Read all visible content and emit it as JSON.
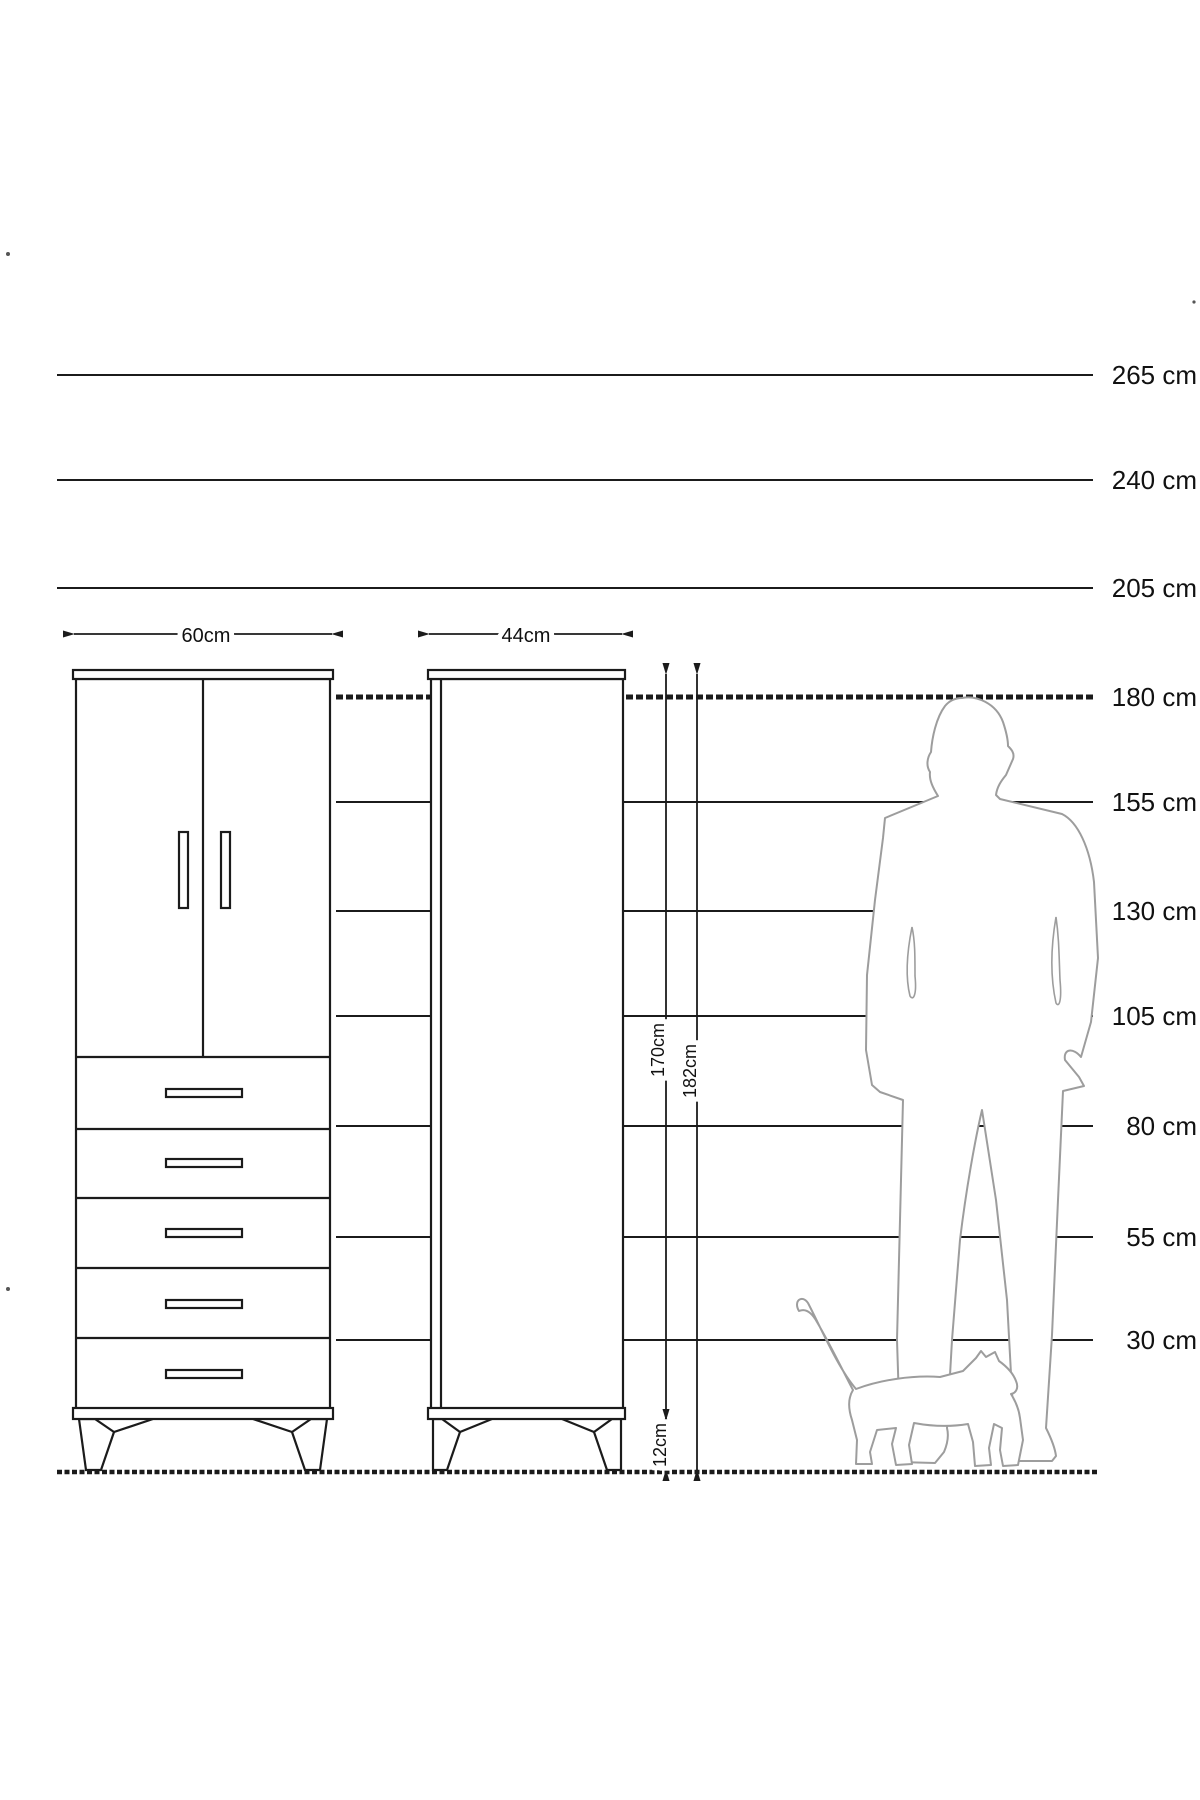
{
  "diagram": {
    "kind": "furniture size comparison diagram",
    "unit": "cm"
  },
  "colors": {
    "line_color": "#1b1b1b",
    "figure_outline": "#9d9d9d",
    "background": "#ffffff"
  },
  "scale": {
    "line_end_x": 1093,
    "label_x": 1197,
    "lines": [
      {
        "label": "265 cm",
        "y": 375,
        "x1": 57,
        "style": "solid"
      },
      {
        "label": "240 cm",
        "y": 480,
        "x1": 57,
        "style": "solid"
      },
      {
        "label": "205 cm",
        "y": 588,
        "x1": 57,
        "style": "solid"
      },
      {
        "label": "180 cm",
        "y": 697,
        "x1": 336,
        "style": "hatched"
      },
      {
        "label": "155 cm",
        "y": 802,
        "x1": 336,
        "style": "solid"
      },
      {
        "label": "130 cm",
        "y": 911,
        "x1": 336,
        "style": "solid"
      },
      {
        "label": "105 cm",
        "y": 1016,
        "x1": 336,
        "style": "solid"
      },
      {
        "label": "80 cm",
        "y": 1126,
        "x1": 336,
        "style": "solid"
      },
      {
        "label": "55 cm",
        "y": 1237,
        "x1": 336,
        "style": "solid"
      },
      {
        "label": "30 cm",
        "y": 1340,
        "x1": 336,
        "style": "solid"
      }
    ],
    "ground": {
      "y": 1472,
      "x1": 57,
      "x2": 1097
    }
  },
  "dimensions": {
    "wardrobe_width": {
      "label": "60cm"
    },
    "cabinet_width": {
      "label": "44cm"
    },
    "cabinet_body_height": {
      "label": "170cm"
    },
    "total_height": {
      "label": "182cm"
    },
    "leg_height": {
      "label": "12cm"
    }
  },
  "figures": {
    "man": "man-silhouette",
    "cat": "cat-silhouette"
  },
  "furniture": {
    "left": "two-door wardrobe with five drawers",
    "right": "tall single cabinet"
  }
}
